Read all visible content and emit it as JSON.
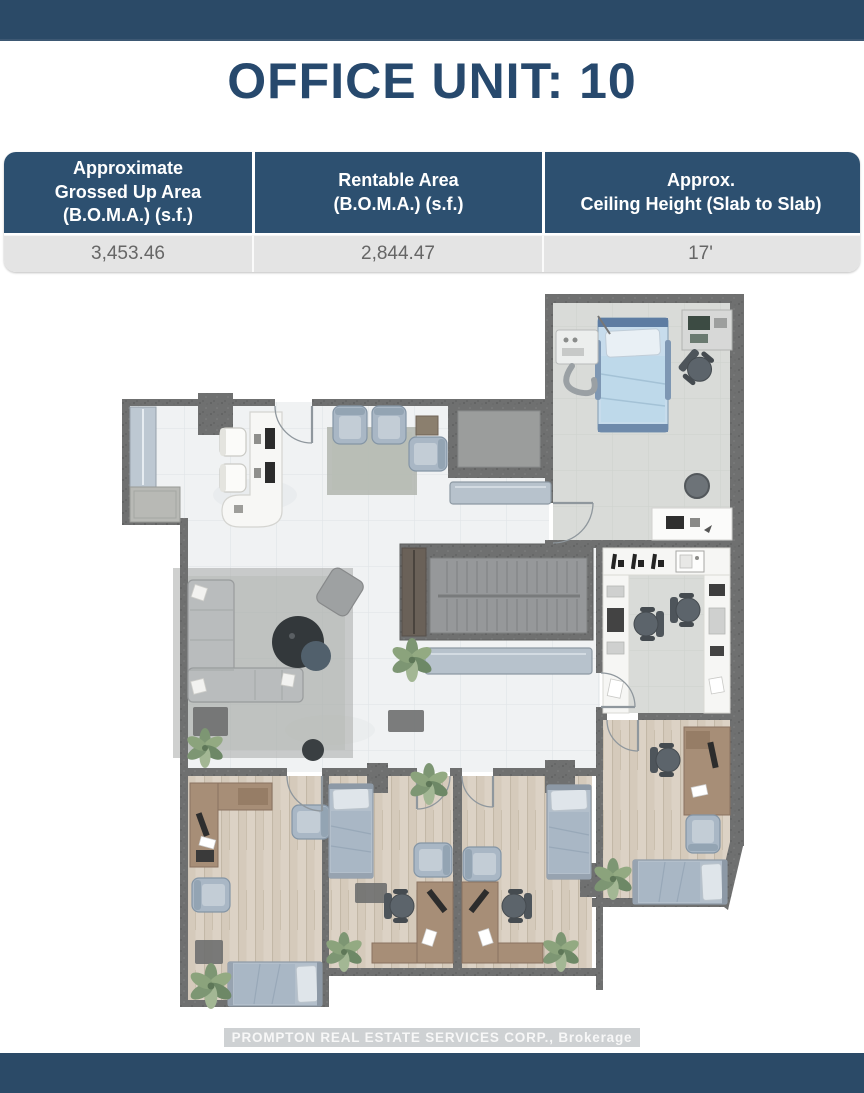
{
  "header": {
    "title": "OFFICE UNIT: 10"
  },
  "table": {
    "columns": [
      {
        "header": "Approximate\nGrossed Up Area\n(B.O.M.A.) (s.f.)",
        "value": "3,453.46"
      },
      {
        "header": "Rentable Area\n(B.O.M.A.) (s.f.)",
        "value": "2,844.47"
      },
      {
        "header": "Approx.\nCeiling Height (Slab to Slab)",
        "value": "17'"
      }
    ]
  },
  "footer": {
    "watermark": "PROMPTON REAL ESTATE SERVICES CORP., Brokerage"
  },
  "colors": {
    "brand_bar": "#2b4a67",
    "title_text": "#27496d",
    "table_header_bg": "#2d5070",
    "table_row_bg": "#e4e4e4",
    "wall_gray": "#6f7070",
    "floor_marble": "#f0f2f3",
    "floor_tile_gray": "#d9dbd8",
    "floor_wood": "#dcd2c5",
    "bench_blue": "#b7c2cc",
    "hospital_bed_blue": "#bed9ea"
  }
}
